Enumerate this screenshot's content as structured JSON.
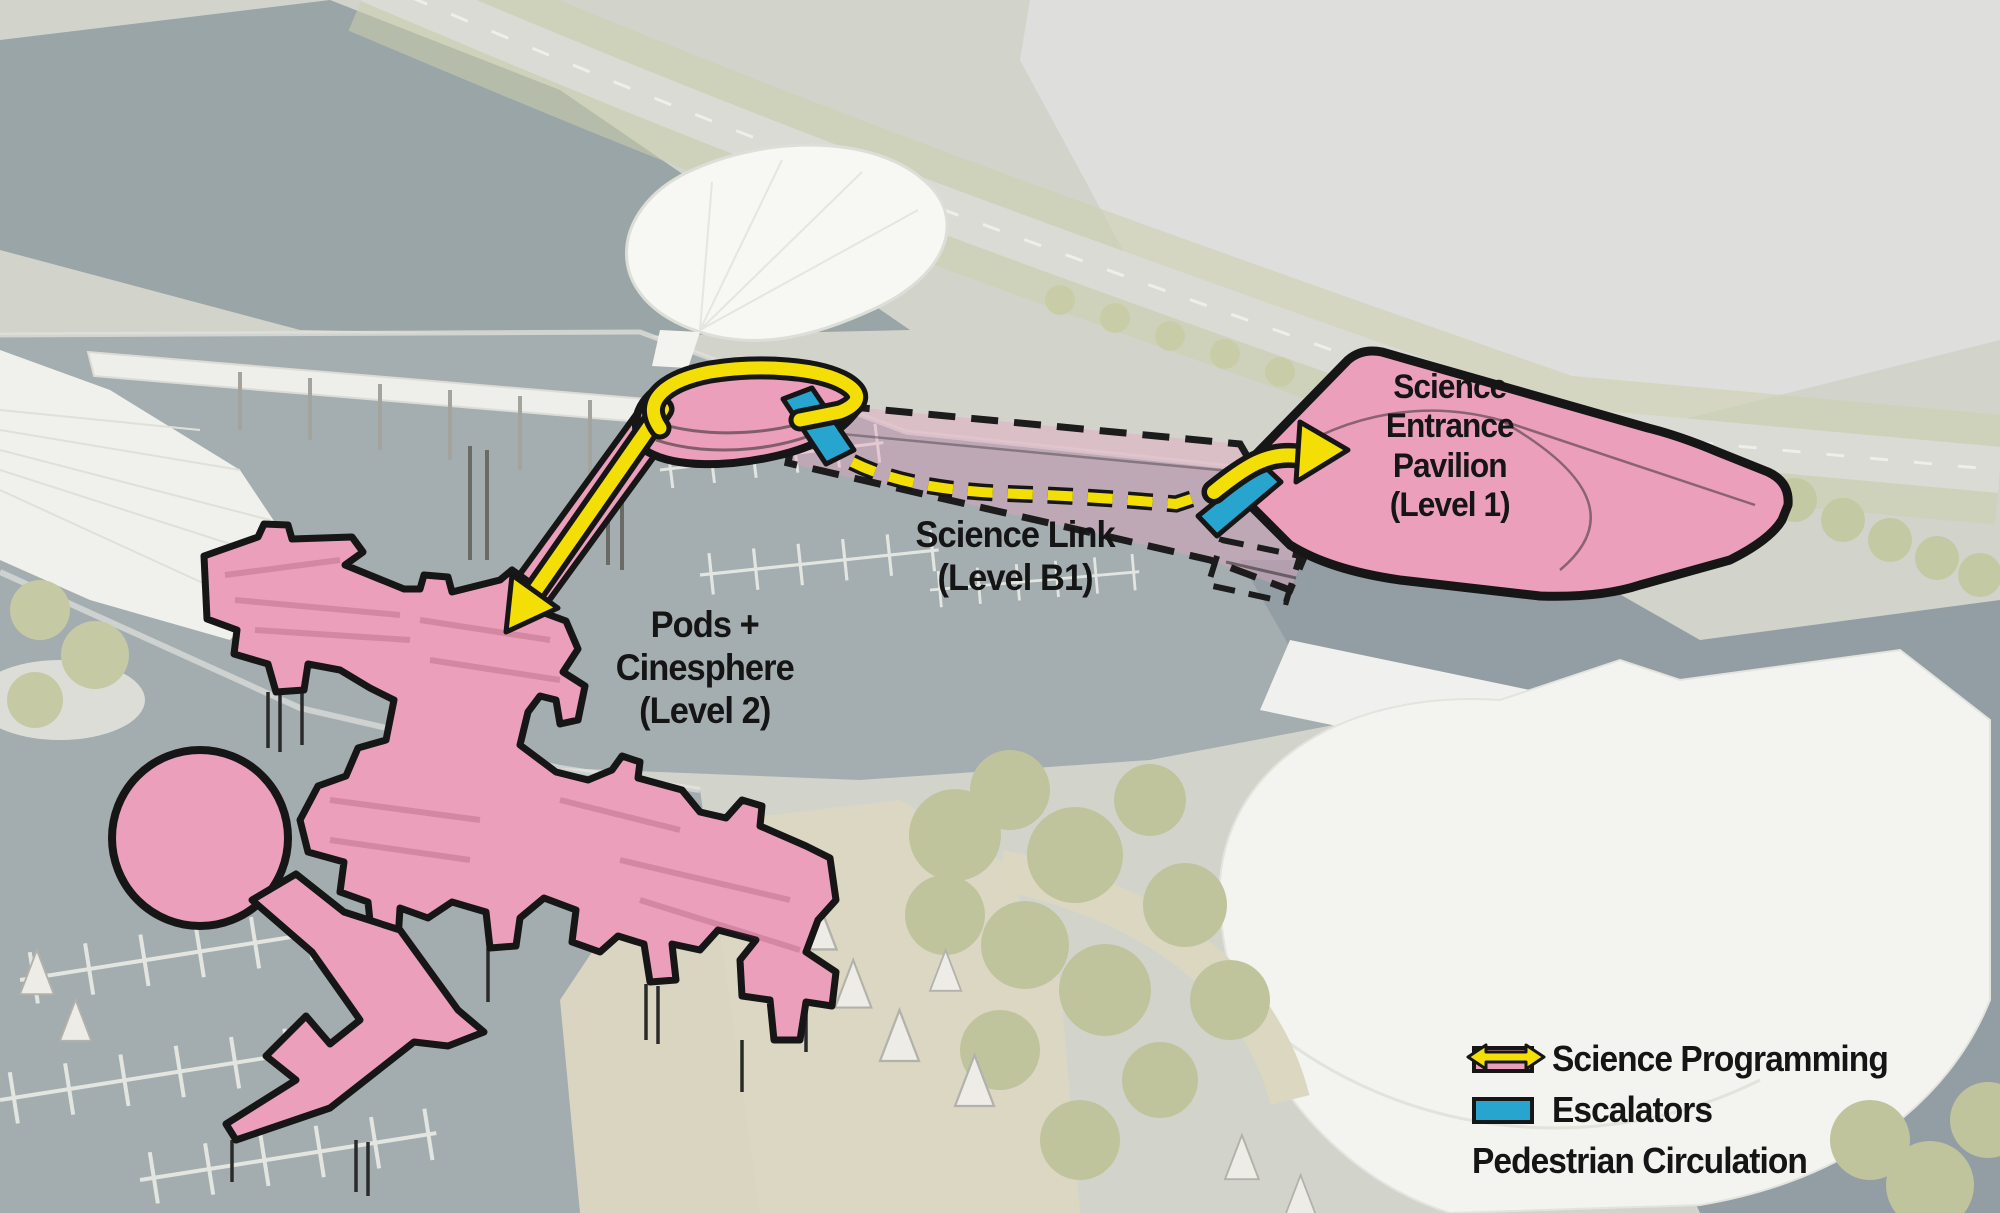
{
  "annotations": {
    "pavilion_label": "Science\nEntrance\nPavilion\n(Level 1)",
    "link_label": "Science Link\n(Level B1)",
    "pods_label": "Pods +\nCinesphere\n(Level 2)"
  },
  "legend": {
    "items": [
      {
        "id": "science-programming",
        "label": "Science Programming",
        "swatch": "rect",
        "color": "#EC9FBA"
      },
      {
        "id": "escalators",
        "label": "Escalators",
        "swatch": "rect",
        "color": "#27A5CF"
      },
      {
        "id": "pedestrian-circulation",
        "label": "Pedestrian Circulation",
        "swatch": "double-arrow",
        "color": "#F3DF06"
      }
    ]
  },
  "colors": {
    "science_programming": "#EC9FBA",
    "science_programming_translucent": "rgba(231,160,190,0.40)",
    "escalators": "#27A5CF",
    "pedestrian_circulation": "#F3DF06",
    "outline": "#161616"
  }
}
